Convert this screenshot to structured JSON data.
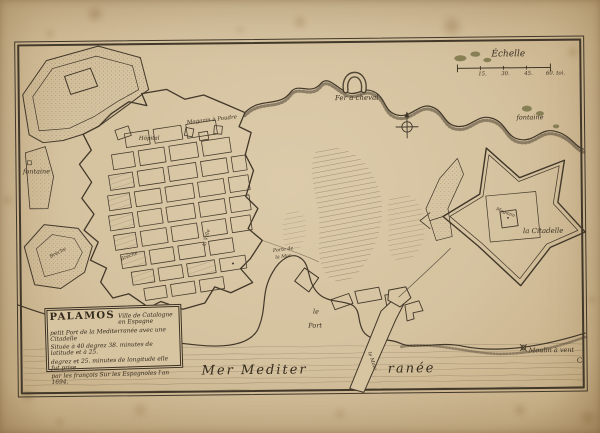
{
  "map_title": "Plan de Palamos",
  "colors": {
    "ink": "#42382a",
    "paper": "#d5c29f"
  },
  "cartouche": {
    "title": "PALAMOS",
    "subtitle": "Ville de Catalogne en Espagne",
    "lines": [
      "petit Port de la Mediterranée avec une Citadelle",
      "Située à 40 degrez 38. minutes de latitude et à 25.",
      "degrez et 25. minutes de longitude elle fut prise",
      "par les françois Sur les Espagnoles l'an 1694."
    ]
  },
  "scale": {
    "title": "Échelle",
    "ticks": [
      "15.",
      "30.",
      "45.",
      "60. toi."
    ]
  },
  "labels": {
    "fer_a_cheval": "Fer a cheval",
    "fontaine_left": "fontaine",
    "fontaine_right": "fontaine",
    "magazin_poudre": "Magazin à Poudre",
    "hopital": "Hôpital",
    "la_ville": "la Ville",
    "porte_de_la_mer_1": "Porte de",
    "porte_de_la_mer_2": "la Mer",
    "breche_left": "Brèche",
    "breche_right": "Brèche",
    "magazin_citadelle": "Magazin",
    "la_citadelle": "la Citadelle",
    "le_port_1": "le",
    "le_port_2": "Port",
    "mole": "le Mole",
    "mer_left": "Mer Mediter",
    "mer_right": "ranée",
    "moulin_a_vent": "Moulin à vent",
    "mark_c": "C"
  }
}
